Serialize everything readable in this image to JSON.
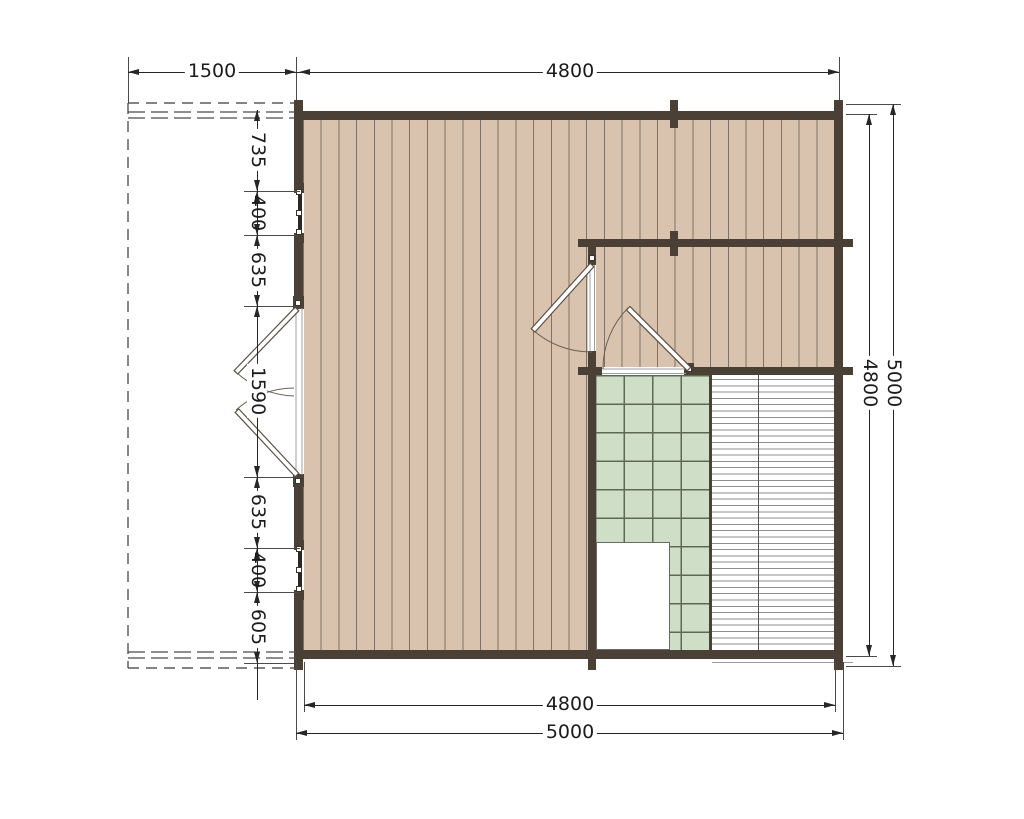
{
  "diagram": {
    "type": "log-cabin-floor-plan",
    "colors": {
      "wall": "#4b4036",
      "plank_floor": "#d9c3ae",
      "plank_line": "#7e7265",
      "tile_fill": "#cfdfc7",
      "tile_line": "#5c6a54",
      "terrace_stripe": "#8e8e8e",
      "dimension_line": "#262626"
    },
    "dimensions": {
      "top_porch_width": "1500",
      "top_interior_width": "4800",
      "left_segments": [
        "735",
        "400",
        "635",
        "1590",
        "635",
        "400",
        "605"
      ],
      "right_interior_height": "4800",
      "right_overall_height": "5000",
      "bottom_interior_width": "4800",
      "bottom_overall_width": "5000"
    }
  }
}
